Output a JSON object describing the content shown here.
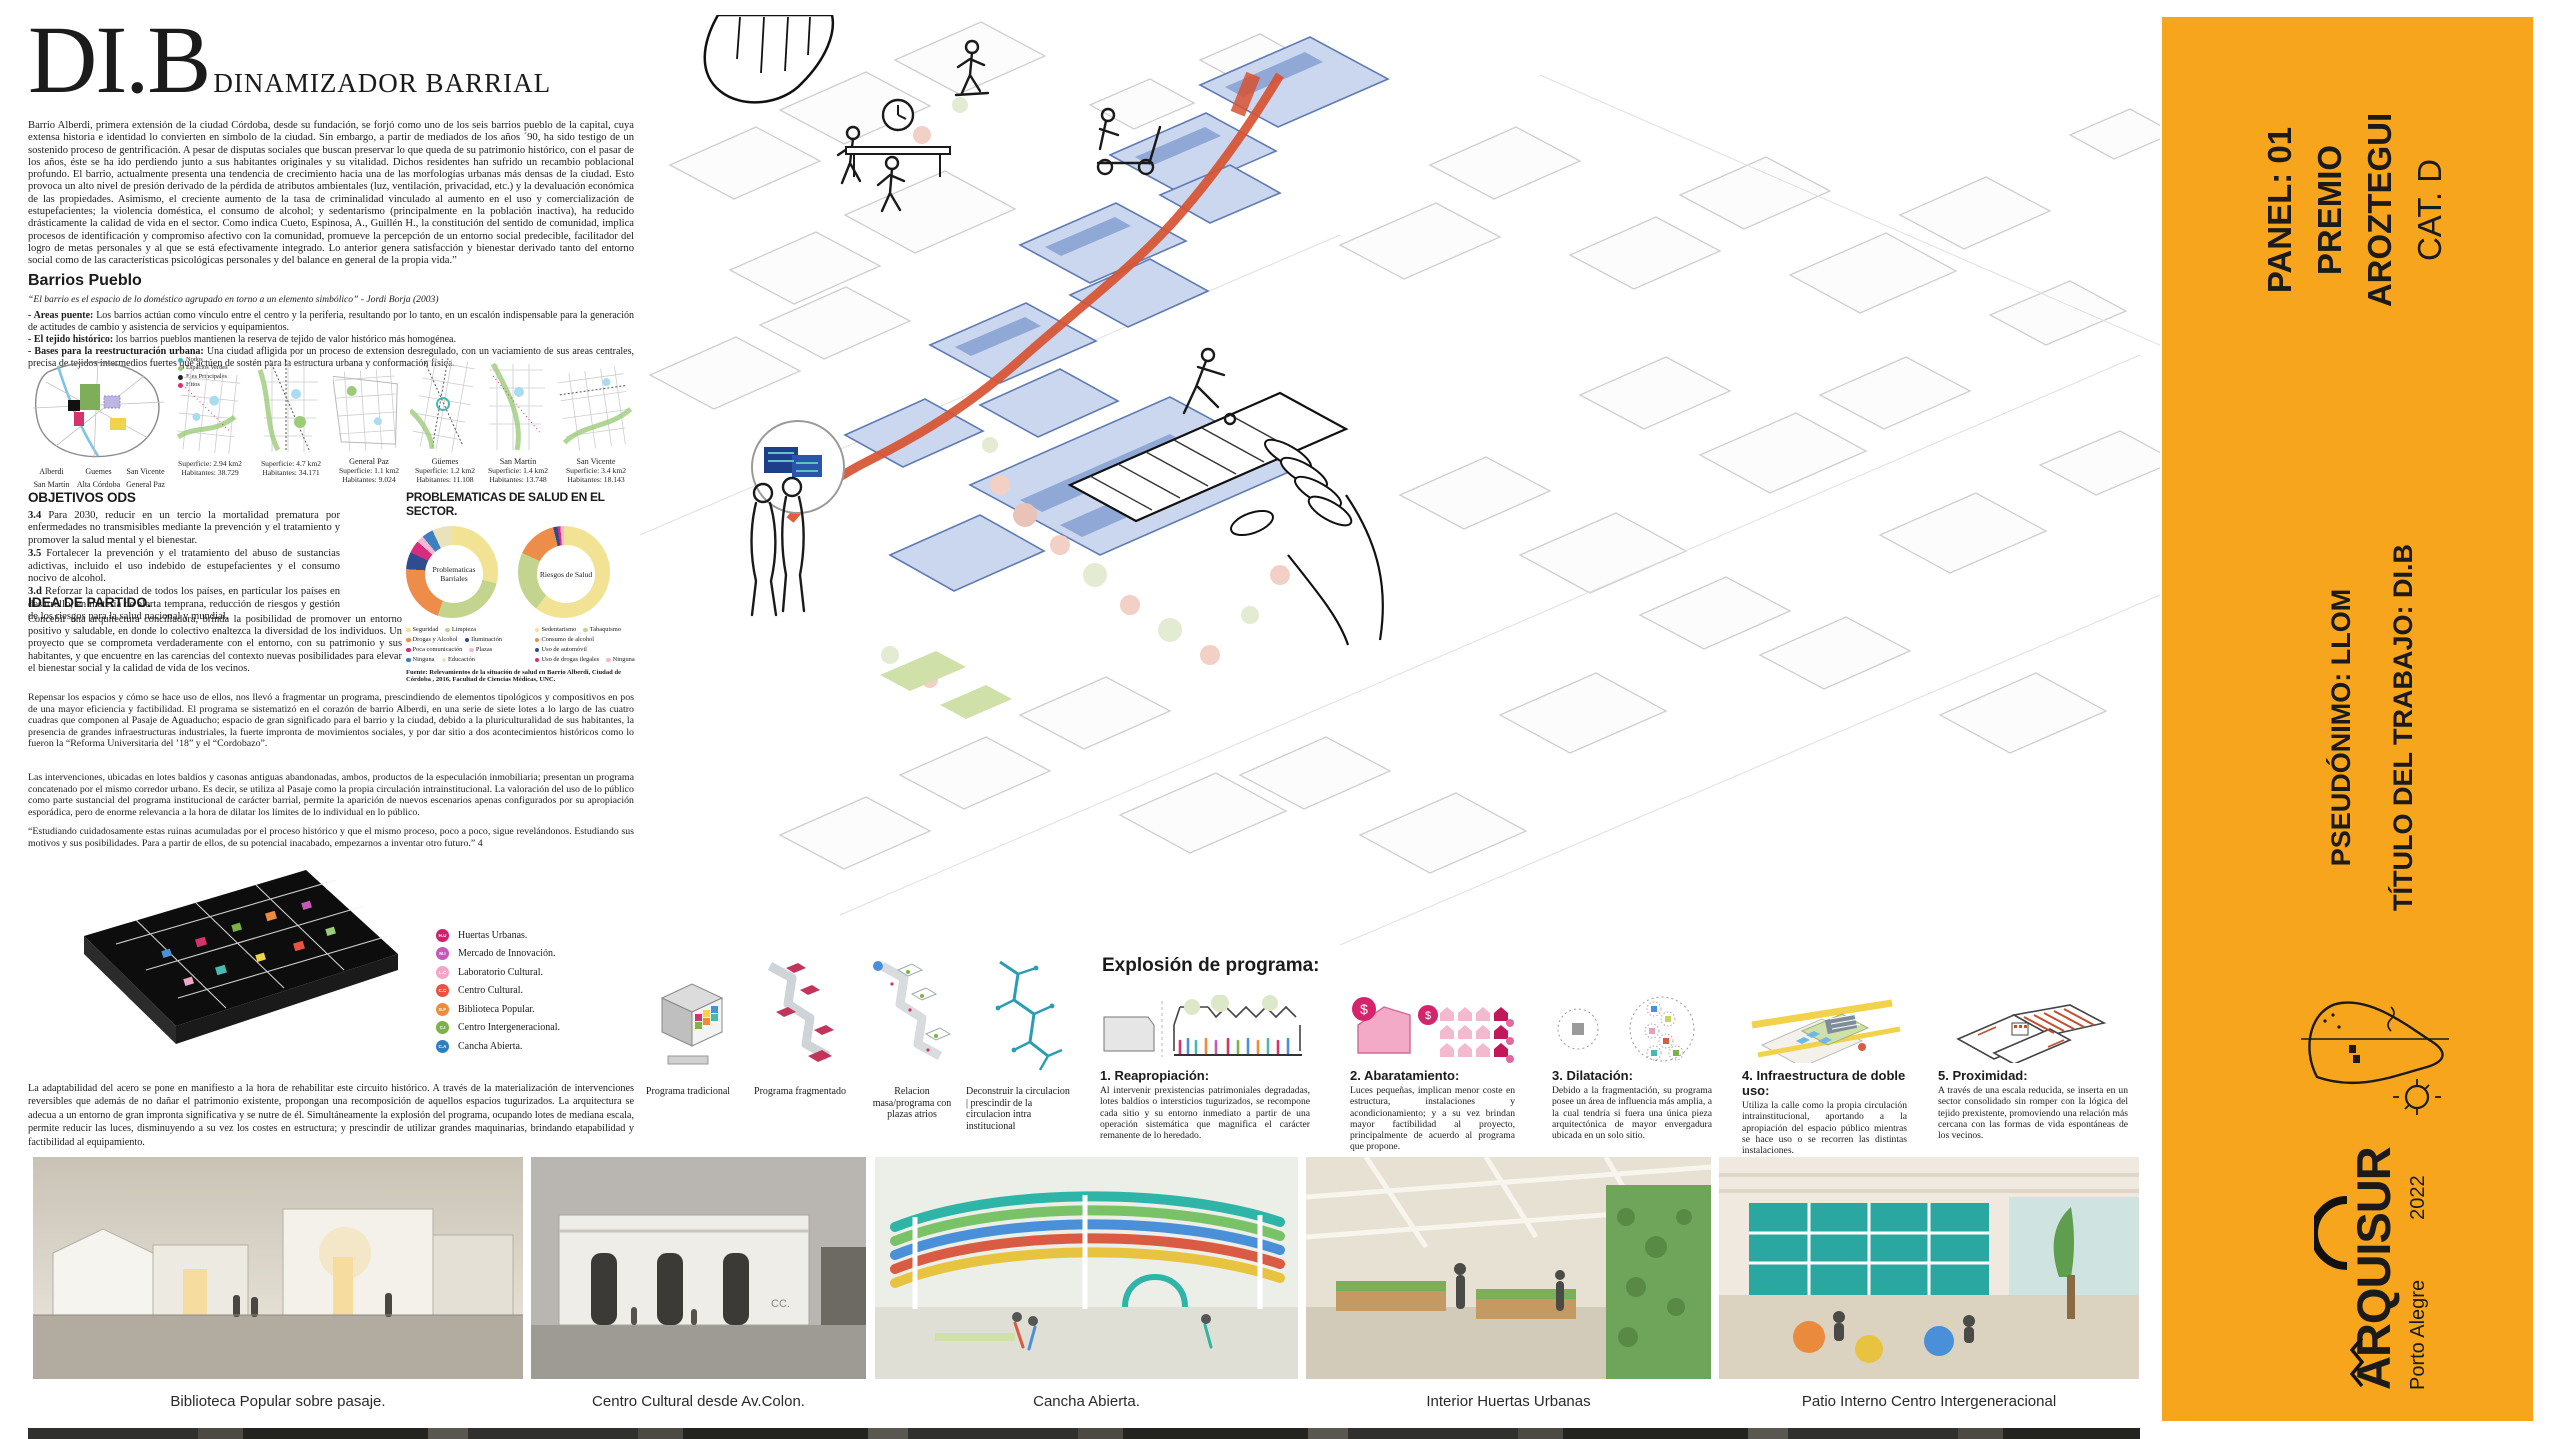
{
  "header": {
    "acronym": "DI.B",
    "subtitle": "DINAMIZADOR BARRIAL"
  },
  "intro": "Barrio Alberdi, primera extensión de la ciudad Córdoba, desde su fundación, se forjó como uno de los seis barrios pueblo de la capital, cuya extensa historia e identidad lo convierten en símbolo de la ciudad. Sin embargo, a partir de mediados de los años ´90, ha sido testigo de un sostenido proceso de gentrificación. A pesar de disputas sociales que buscan preservar lo que queda de su patrimonio histórico, con el pasar de los años, éste se ha ido perdiendo junto a sus habitantes originales y su vitalidad. Dichos residentes han sufrido un recambio poblacional profundo. El barrio, actualmente presenta una tendencia de crecimiento hacia una de las morfologías urbanas más densas de la ciudad. Esto provoca un alto nivel de presión derivado de la pérdida de atributos ambientales (luz, ventilación, privacidad, etc.) y la devaluación económica de las propiedades. Asimismo, el creciente aumento de la tasa de criminalidad vinculado al aumento en el uso y comercialización de estupefacientes; la violencia doméstica, el consumo de alcohol; y sedentarismo (principalmente en la población inactiva), ha reducido drásticamente la calidad de vida en el sector. Como indica Cueto, Espinosa, A., Guillén H., la constitución del sentido de comunidad, implica procesos de identificación y compromiso afectivo con la comunidad, promueve la percepción de un entorno social predecible, facilitador del logro de metas personales y al que se está efectivamente integrado. Lo anterior genera satisfacción y bienestar derivado tanto del entorno social como de las características psicológicas personales y del balance en general de la propia vida.”",
  "barrios": {
    "heading": "Barrios Pueblo",
    "quote": "“El barrio es el espacio de lo doméstico agrupado en torno a un elemento simbólico” - Jordi Borja (2003)",
    "bullets": [
      {
        "lead": "- Areas puente:",
        "text": "Los barrios actúan como vínculo entre el centro y la periferia, resultando por lo tanto, en un escalón indispensable para la generación de actitudes de cambio y asistencia de servicios y equipamientos."
      },
      {
        "lead": "- El tejido histórico:",
        "text": "los barrios pueblos mantienen la reserva de tejido de valor histórico más homogénea."
      },
      {
        "lead": "- Bases para la reestructuración urbana:",
        "text": "Una ciudad afligida por un proceso de extension desregulado, con un vaciamiento de sus areas centrales, precisa de tejidos intermedios fuertes que actúen de sostén para la estructura urbana y conformación física."
      }
    ]
  },
  "maps": {
    "key": [
      {
        "label": "Nodos",
        "color": "#49B8B0"
      },
      {
        "label": "Espacios Verdes",
        "color": "#9CCB7A"
      },
      {
        "label": "Ejes Principales",
        "color": "#222222"
      },
      {
        "label": "Hitos",
        "color": "#D6336C"
      }
    ],
    "districts": [
      "Alberdi",
      "Guemes",
      "San Vicente",
      "San Martín",
      "Alta Córdoba",
      "General Paz"
    ],
    "thumbs": [
      {
        "name": "",
        "superficie": "Superficie: 2.94 km2",
        "habitantes": "Habitantes: 38.729"
      },
      {
        "name": "",
        "superficie": "Superficie: 4.7 km2",
        "habitantes": "Habitantes: 34.171"
      },
      {
        "name": "General Paz",
        "superficie": "Superficie: 1.1 km2",
        "habitantes": "Habitantes: 9.024"
      },
      {
        "name": "Güemes",
        "superficie": "Superficie: 1.2 km2",
        "habitantes": "Habitantes: 11.108"
      },
      {
        "name": "San Martín",
        "superficie": "Superficie: 1.4 km2",
        "habitantes": "Habitantes: 13.748"
      },
      {
        "name": "San Vicente",
        "superficie": "Superficie: 3.4 km2",
        "habitantes": "Habitantes: 18.143"
      }
    ]
  },
  "ods": {
    "heading": "OBJETIVOS ODS",
    "items": [
      {
        "num": "3.4",
        "text": "Para 2030, reducir en un tercio la mortalidad prematura por enfermedades no transmisibles mediante la prevención y el tratamiento y promover la salud mental y el bienestar."
      },
      {
        "num": "3.5",
        "text": "Fortalecer la prevención y el tratamiento del abuso de sustancias adictivas, incluido el uso indebido de estupefacientes y el consumo nocivo de alcohol."
      },
      {
        "num": "3.d",
        "text": "Reforzar la capacidad de todos los países, en particular los países en desarrollo, en materia de alerta temprana, reducción de riesgos y gestión de los riesgos para la salud nacional y mundial."
      }
    ]
  },
  "salud": {
    "heading": "PROBLEMATICAS DE SALUD EN EL SECTOR.",
    "fuente": "Fuente: Relevamientos de la situación de salud en Barrio Alberdi, Ciudad de Córdoba , 2016, Facultad de Ciencias Médicas, UNC."
  },
  "chart_data": [
    {
      "type": "pie",
      "name": "Problematicas Barriales",
      "slices": [
        {
          "label": "Seguridad",
          "value": 29,
          "color": "#F2E394"
        },
        {
          "label": "Limpieza",
          "value": 26,
          "color": "#C3D48E"
        },
        {
          "label": "Drogas y Alcohol",
          "value": 21,
          "color": "#EE8C4A"
        },
        {
          "label": "Iluminación",
          "value": 6,
          "color": "#2F4D8E"
        },
        {
          "label": "Poca comunicación",
          "value": 4.5,
          "color": "#D62E7C"
        },
        {
          "label": "Plazas",
          "value": 2.5,
          "color": "#F2B9D2"
        },
        {
          "label": "Ninguna",
          "value": 4,
          "color": "#3E7FC1"
        },
        {
          "label": "Educación",
          "value": 7,
          "color": "#E9E3BC"
        }
      ]
    },
    {
      "type": "pie",
      "name": "Riesgos de Salud",
      "slices": [
        {
          "label": "Sedentarismo",
          "value": 60.4,
          "color": "#F2E394"
        },
        {
          "label": "Tabaquismo",
          "value": 21.4,
          "color": "#C3D48E"
        },
        {
          "label": "Consumo de alcohol",
          "value": 14.4,
          "color": "#EE8C4A"
        },
        {
          "label": "Uso de automóvil",
          "value": 1.5,
          "color": "#2F4D8E"
        },
        {
          "label": "Uso de drogas ilegales",
          "value": 1.0,
          "color": "#D62E7C"
        },
        {
          "label": "Ninguna",
          "value": 1.3,
          "color": "#F2B9D2"
        }
      ]
    }
  ],
  "idea": {
    "heading": "IDEA DE PARTIDO.",
    "p1": "Concebir una arquitectura conciliadora, brinda la posibilidad de promover un entorno positivo y saludable, en donde lo colectivo enaltezca la diversidad de los individuos. Un proyecto que se comprometa verdaderamente con el entorno, con su patrimonio y sus habitantes, y que encuentre en las carencias del contexto nuevas posibilidades para elevar el bienestar social y la calidad de vida de los vecinos.",
    "p2": "Repensar los espacios y cómo se hace uso de ellos, nos llevó a fragmentar un programa, prescindiendo de elementos tipológicos y compositivos en pos de una mayor eficiencia y factibilidad. El programa se sistematizó en el corazón de barrio Alberdi, en una serie de siete lotes a lo largo de las cuatro cuadras que componen al Pasaje de Aguaducho; espacio de gran significado para el barrio y la ciudad, debido a la pluriculturalidad de sus habitantes, la presencia de grandes infraestructuras industriales, la fuerte impronta de movimientos sociales, y por dar sitio a dos acontecimientos históricos como lo fueron la “Reforma Universitaria del ’18” y el “Cordobazo”.",
    "p3": "Las intervenciones, ubicadas en lotes baldíos y casonas antiguas abandonadas, ambos, productos de la especulación inmobiliaria; presentan un programa concatenado por el mismo corredor urbano. Es decir, se utiliza al Pasaje como la propia circulación intrainstitucional. La valoración del uso de lo público como parte sustancial del programa institucional de carácter barrial, permite la aparición de nuevos escenarios apenas configurados por su apropiación esporádica, pero de enorme relevancia a la hora de dilatar los límites de lo individual en lo público.",
    "p4": "“Estudiando cuidadosamente estas ruinas acumuladas por el proceso histórico y que el mismo proceso, poco a poco, sigue revelándonos. Estudiando sus motivos y sus posibilidades. Para a partir de ellos, de su potencial inacabado, empezarnos a inventar otro futuro.” 4"
  },
  "axon_legend": [
    {
      "code": "H.U",
      "label": "Huertas Urbanas.",
      "color": "#D0206A"
    },
    {
      "code": "M.I",
      "label": "Mercado de Innovación.",
      "color": "#C558B8"
    },
    {
      "code": "L.C",
      "label": "Laboratorio Cultural.",
      "color": "#F0A8C8"
    },
    {
      "code": "C.C",
      "label": "Centro Cultural.",
      "color": "#E4543F"
    },
    {
      "code": "B.P",
      "label": "Biblioteca Popular.",
      "color": "#ED8C3A"
    },
    {
      "code": "C.I",
      "label": "Centro Intergeneracional.",
      "color": "#7CB342"
    },
    {
      "code": "C.A",
      "label": "Cancha Abierta.",
      "color": "#2D7FC1"
    }
  ],
  "acero": "La adaptabilidad del acero se pone en manifiesto a la hora de rehabilitar este circuito histórico. A través de la materialización de intervenciones reversibles que además de no dañar el patrimonio existente, propongan una recomposición de aquellos espacios tugurizados. La arquitectura se adecua a un entorno de gran impronta significativa y se nutre de él. Simultáneamente la explosión del programa, ocupando lotes de mediana escala, permite reducir las luces, disminuyendo a su vez los costes en estructura; y prescindir de utilizar grandes maquinarias, brindando etapabilidad y factibilidad al equipamiento.",
  "diagrams": {
    "captions": [
      "Programa tradicional",
      "Programa fragmentado",
      "Relacion masa/programa con plazas atrios",
      "Deconstruir la circulacion | prescindir de la circulacion intra institucional"
    ]
  },
  "explosion": {
    "heading": "Explosión de programa:",
    "items": [
      {
        "title": "1. Reapropiación:",
        "text": "Al intervenir prexistencias patrimoniales degradadas, lotes baldíos o intersticios tugurizados, se recompone cada sitio y su entorno inmediato a partir de una operación sistemática que magnifica el carácter remanente de lo heredado."
      },
      {
        "title": "2. Abaratamiento:",
        "text": "Luces pequeñas, implican menor coste en estructura, instalaciones y acondicionamiento; y a su vez brindan mayor factibilidad al proyecto, principalmente de acuerdo al programa que propone."
      },
      {
        "title": "3. Dilatación:",
        "text": "Debido a la fragmentación, su programa posee un área de influencia más amplia, a la cual tendría si fuera una única pieza arquitectónica de mayor envergadura ubicada en un solo sitio."
      },
      {
        "title": "4. Infraestructura de doble uso:",
        "text": "Utiliza la calle como la propia circulación intrainstitucional, aportando a la apropiación del espacio público mientras se hace uso o se recorren las distintas instalaciones."
      },
      {
        "title": "5. Proximidad:",
        "text": "A través de una escala reducida, se inserta en un sector consolidado sin romper con la lógica del tejido prexistente, promoviendo una relación más cercana con las formas de vida espontáneas de los vecinos."
      }
    ]
  },
  "photos": {
    "captions": [
      "Biblioteca Popular sobre pasaje.",
      "Centro Cultural  desde Av.Colon.",
      "Cancha Abierta.",
      "Interior Huertas Urbanas",
      "Patio Interno Centro Intergeneracional"
    ]
  },
  "sidebar": {
    "panel": "PANEL: 01",
    "premio": "PREMIO",
    "aroztegui": "AROZTEGUI",
    "category": "CAT. D",
    "pseudonimo": "PSEUDÓNIMO: LLOM",
    "titulo": "TÍTULO DEL TRABAJO: DI.B",
    "brand": "ARQUISUR",
    "year": "2022",
    "city": "Porto Alegre",
    "accent_color": "#F6A51D"
  }
}
